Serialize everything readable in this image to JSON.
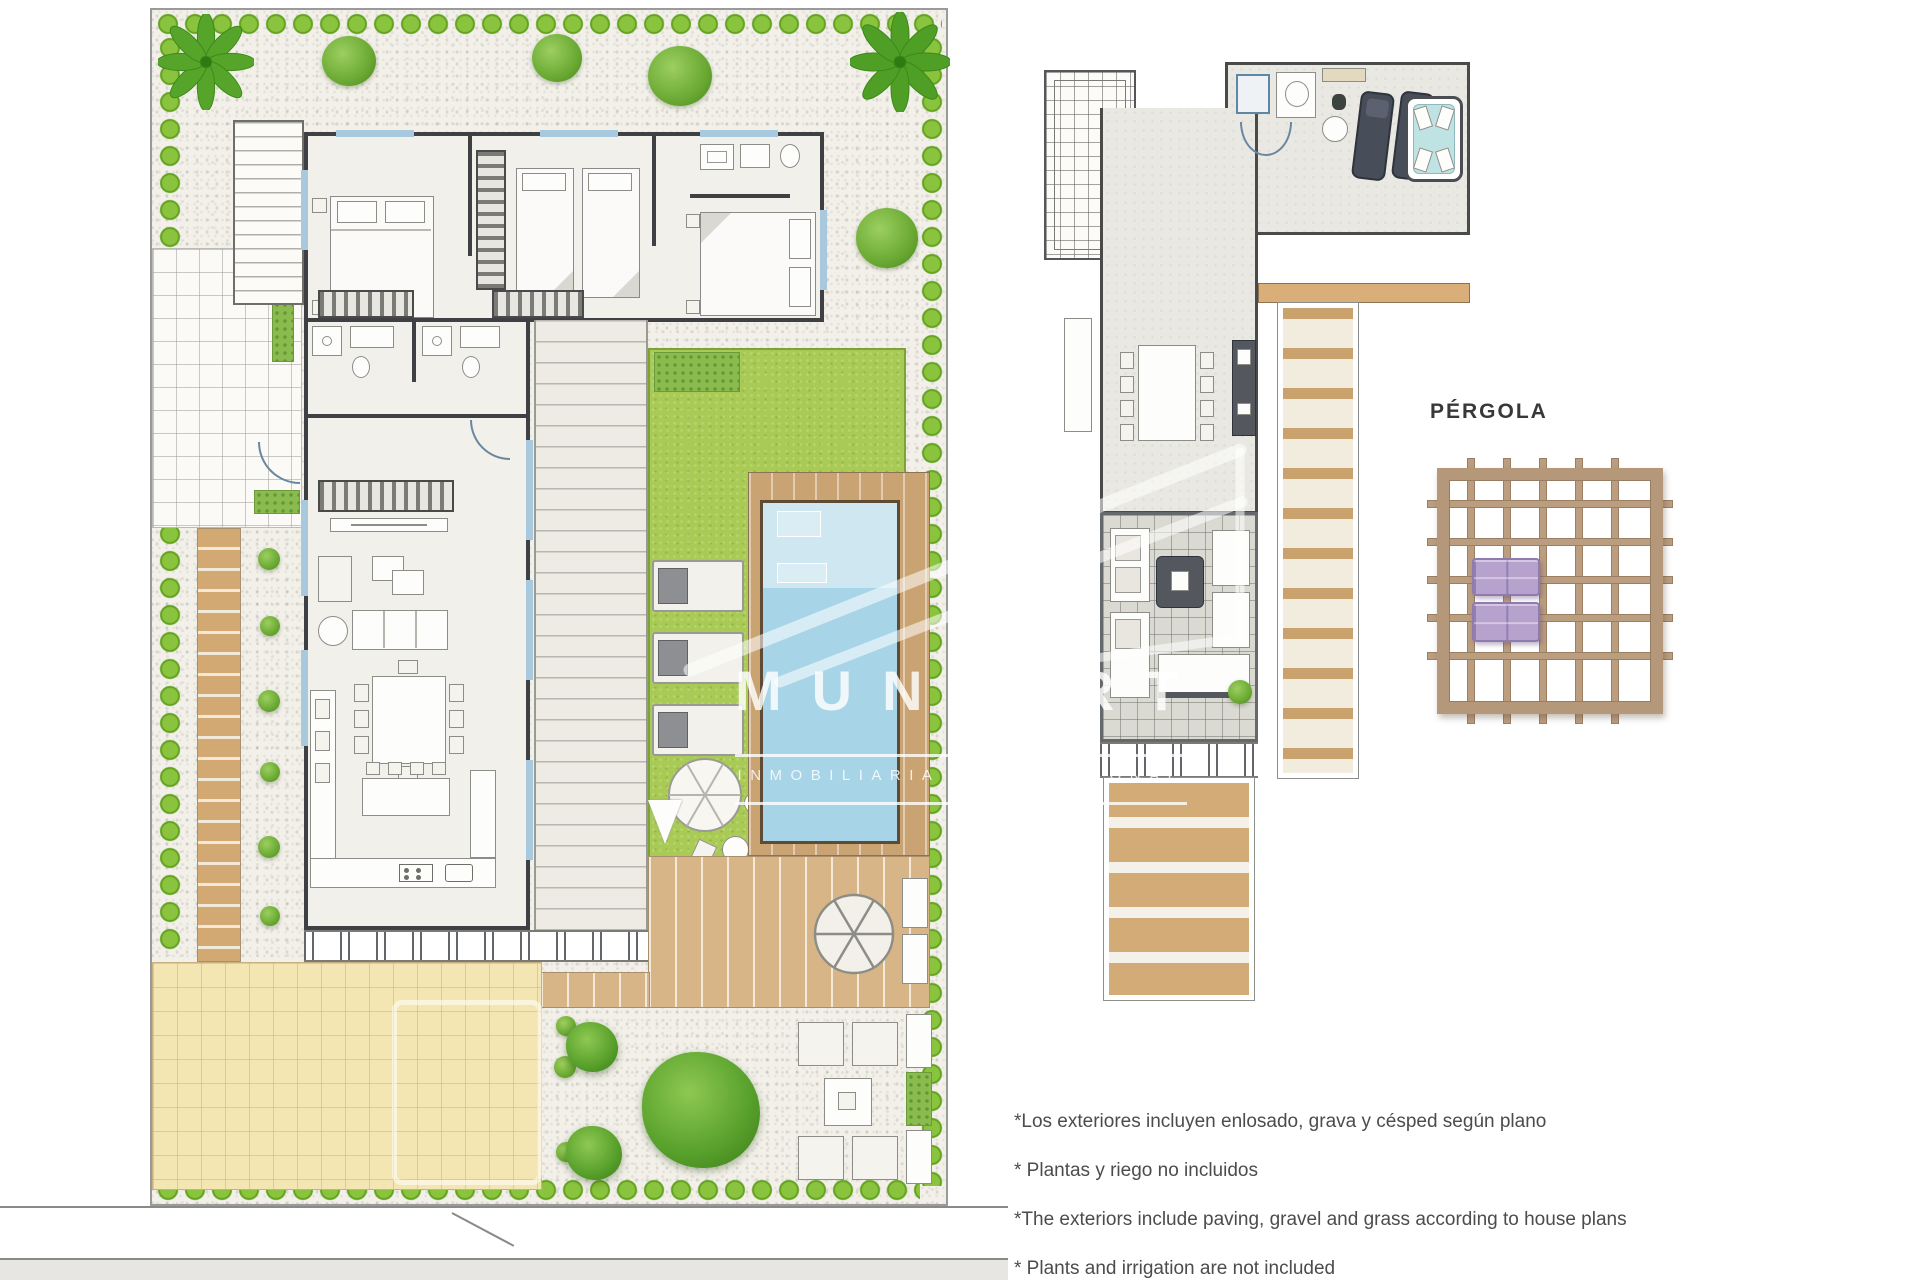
{
  "watermark": {
    "brand_prefix": "MUNP",
    "brand_suffix": "RT",
    "tagline": "INMOBILIARIA INTERNACIONAL"
  },
  "pergola": {
    "label": "PÉRGOLA"
  },
  "notes": [
    "*Los exteriores incluyen enlosado, grava y césped según plano",
    "* Plantas y riego no incluidos",
    "*The exteriors include paving, gravel and grass according to house plans",
    "* Plants and irrigation are not included"
  ],
  "colors": {
    "hedge_green": "#63a21f",
    "lawn_green": "#a9cb55",
    "pool_blue": "#a7d4e6",
    "deck_wood": "#d2ab76",
    "pergola_wood": "#b5977a",
    "lounger_purple": "#b7a2ce",
    "note_text": "#4c4c4c"
  },
  "icons": {
    "palm_tree": "palm-tree-icon",
    "shrub": "shrub-icon",
    "parasol": "parasol-icon",
    "brand_logo": "munport-logo-icon"
  }
}
